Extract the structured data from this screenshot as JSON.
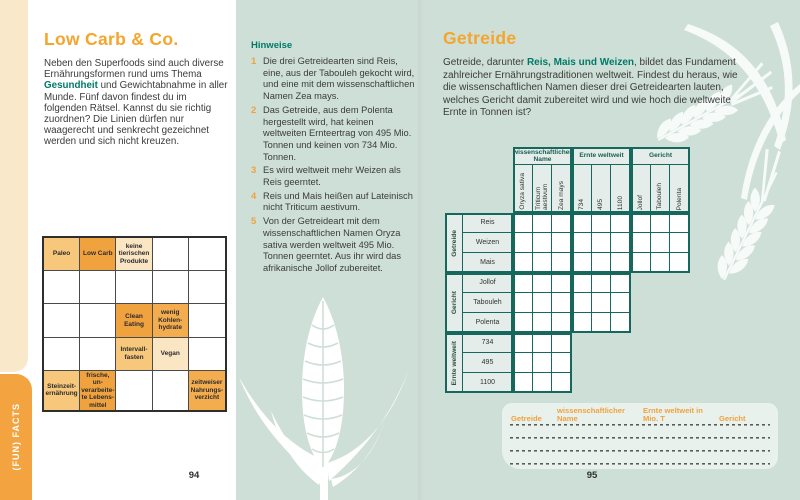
{
  "colors": {
    "accent_orange": "#F4A52C",
    "cell_orange_strong": "#F0A23E",
    "cell_orange_light": "#F7C87C",
    "cell_orange_medium": "#F3AD4F",
    "cell_orange_pale": "#FBE6C4",
    "teal_text": "#007A68",
    "teal_background": "#CEDFD7",
    "logic_grid_line": "#17685C",
    "sidebar_orange": "#F3A440",
    "edge_cream": "#FAE8CA"
  },
  "left_page": {
    "sidebar_tab_label": "(FUN) FACTS",
    "title": "Low Carb & Co.",
    "intro": {
      "part1": "Neben den Superfoods sind auch diverse Ernährungsformen rund ums Thema ",
      "highlight": "Gesundheit",
      "part2": " und Gewichtabnahme in aller Munde. Fünf davon findest du im folgenden Rätsel. Kannst du sie richtig zuordnen? Die Linien dürfen nur waagerecht und senkrecht gezeichnet werden und sich nicht kreuzen."
    },
    "puzzle_grid": {
      "rows": 5,
      "cols": 5,
      "cells": [
        {
          "row": 0,
          "col": 0,
          "label": "Paleo",
          "tone": "light"
        },
        {
          "row": 0,
          "col": 1,
          "label": "Low Carb",
          "tone": "strong"
        },
        {
          "row": 0,
          "col": 2,
          "label": "keine tierischen Produkte",
          "tone": "pale"
        },
        {
          "row": 2,
          "col": 2,
          "label": "Clean Eating",
          "tone": "strong"
        },
        {
          "row": 2,
          "col": 3,
          "label": "wenig Kohlen­hydrate",
          "tone": "medium"
        },
        {
          "row": 3,
          "col": 2,
          "label": "Intervall­fasten",
          "tone": "light"
        },
        {
          "row": 3,
          "col": 3,
          "label": "Vegan",
          "tone": "pale"
        },
        {
          "row": 4,
          "col": 0,
          "label": "Steinzeit­ernährung",
          "tone": "light"
        },
        {
          "row": 4,
          "col": 1,
          "label": "frische, un­verarbeite­te Lebens­mittel",
          "tone": "strong"
        },
        {
          "row": 4,
          "col": 4,
          "label": "zeitweiser Nahrungs­verzicht",
          "tone": "medium"
        }
      ]
    },
    "hints": {
      "title": "Hinweise",
      "items": [
        {
          "num": "1",
          "text": "Die drei Getreidearten sind Reis, eine, aus der Tabouleh gekocht wird, und eine mit dem wissenschaftlichen Namen Zea mays."
        },
        {
          "num": "2",
          "text": "Das Getreide, aus dem Polenta hergestellt wird, hat keinen weltweiten Ernteertrag von 495 Mio. Tonnen und keinen von 734 Mio. Tonnen."
        },
        {
          "num": "3",
          "text": "Es wird weltweit mehr Weizen als Reis geerntet."
        },
        {
          "num": "4",
          "text": "Reis und Mais heißen auf Lateinisch nicht Triticum aestivum."
        },
        {
          "num": "5",
          "text": "Von der Getreideart mit dem wissenschaftlichen Namen Oryza sativa werden weltweit 495 Mio. Tonnen geerntet. Aus ihr wird das afrikanische Jollof zubereitet."
        }
      ]
    },
    "page_number": "94"
  },
  "right_page": {
    "title": "Getreide",
    "intro": {
      "part1": "Getreide, darunter ",
      "highlight": "Reis, Mais und Weizen",
      "part2": ", bildet das Fundament zahlreicher Ernährungstraditionen weltweit. Findest du heraus, wie die wissenschaftlichen Namen dieser drei Getreidearten lauten, welches Gericht damit zubereitet wird und wie hoch die weltweite Ernte in Tonnen ist?"
    },
    "logic_grid": {
      "col_groups": [
        {
          "label": "wissenschaftlicher Name",
          "cols": [
            "Oryza sativa",
            "Triticum aestivum",
            "Zea mays"
          ]
        },
        {
          "label": "Ernte weltweit",
          "cols": [
            "734",
            "495",
            "1100"
          ]
        },
        {
          "label": "Gericht",
          "cols": [
            "Jollof",
            "Tabouleh",
            "Polenta"
          ]
        }
      ],
      "row_groups": [
        {
          "label": "Getreide",
          "rows": [
            "Reis",
            "Weizen",
            "Mais"
          ],
          "cells_per_row": 9
        },
        {
          "label": "Gericht",
          "rows": [
            "Jollof",
            "Tabouleh",
            "Polenta"
          ],
          "cells_per_row": 6
        },
        {
          "label": "Ernte weltweit",
          "rows": [
            "734",
            "495",
            "1100"
          ],
          "cells_per_row": 3
        }
      ]
    },
    "answer_table": {
      "headers": [
        "Getreide",
        "wissenschaftlicher Name",
        "Ernte weltweit in Mio. T",
        "Gericht"
      ],
      "answer_lines": 4
    },
    "page_number": "95"
  }
}
